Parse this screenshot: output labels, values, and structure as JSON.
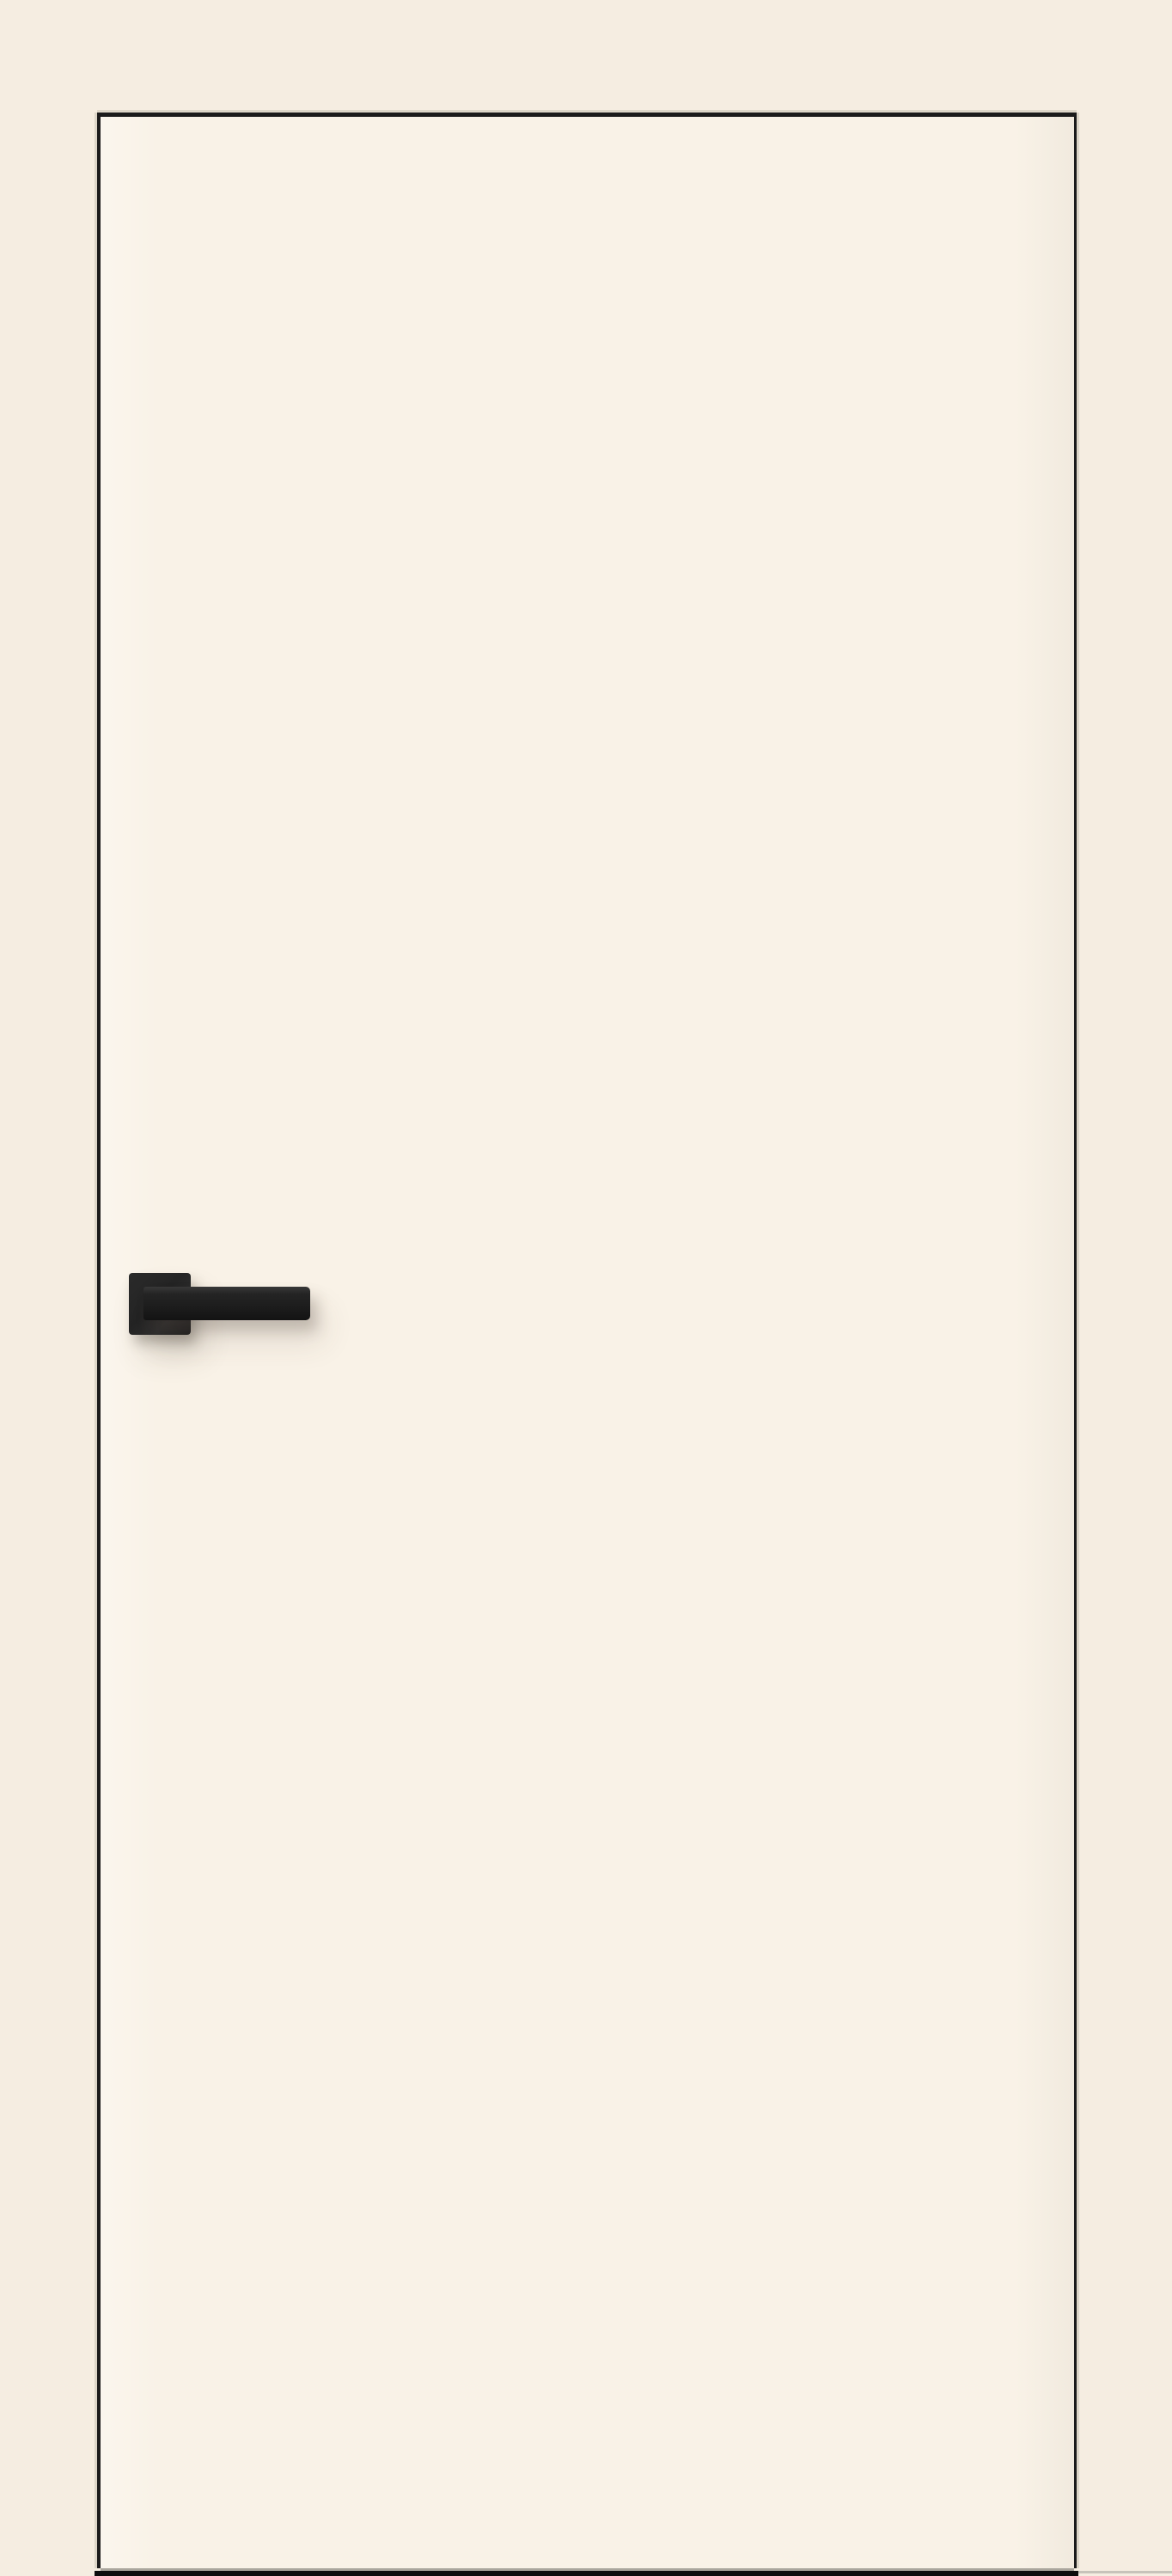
{
  "scene": {
    "objects": [
      "door-leaf",
      "door-handle",
      "handle-rosette",
      "handle-lever",
      "floor-bar"
    ],
    "colors": {
      "background": "#f5ede1",
      "door_face": "#f9f2e7",
      "door_outline": "#1b1b1b",
      "edge_highlight": "#ddd6c8",
      "handle_rosette": "#2a2a2a",
      "handle_lever": "#1e1e1e",
      "handle_lever_top": "#383838",
      "door_bottom_line": "#aaa69d",
      "floor_bar": "#0d0d0d",
      "floor_line_right": "#c7c3ba",
      "shadow": "rgba(70,60,50,0.28)"
    }
  }
}
